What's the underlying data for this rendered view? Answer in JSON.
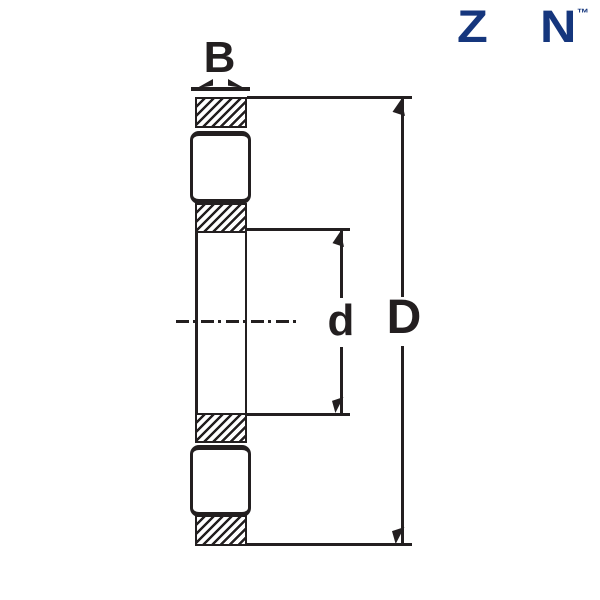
{
  "colors": {
    "ink": "#231f20",
    "navy": "#15367d",
    "background": "#ffffff",
    "sphere_main": "#1479cd",
    "sphere_light": "#63b5ec",
    "sphere_dark": "#0a4190"
  },
  "logo": {
    "letter_z": "Z",
    "letter_n": "N",
    "trademark": "™",
    "ball_icon": "bearing-ball"
  },
  "dimensions": {
    "width_label": "B",
    "bore_label": "d",
    "outer_diameter_label": "D"
  }
}
